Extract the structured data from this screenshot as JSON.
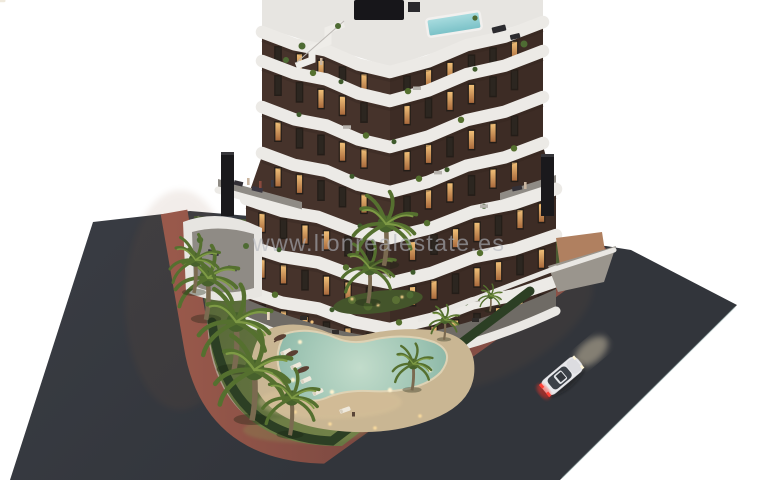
{
  "meta": {
    "type": "architectural-render",
    "description": "Aerial dusk 3D rendering of a modern apartment building with curved white balconies, rooftop plunge pool, landscaped garden with freeform swimming pool, palm trees and sun loungers, on a corner plot between two asphalt roads with a red-brown sidewalk; a white car drives on the right road."
  },
  "watermark": {
    "text": "www.lionrealestate.es"
  },
  "scene": {
    "elements": [
      "apartment-building",
      "rooftop-terrace",
      "rooftop-plunge-pool",
      "balcony-bands",
      "chimneys",
      "garden",
      "freeform-pool",
      "pool-deck",
      "sun-loungers",
      "parasols",
      "palm-trees",
      "hedge",
      "sidewalk-path",
      "asphalt-roads",
      "white-car",
      "watermark"
    ],
    "car": {
      "color": "white",
      "taillights_on": true,
      "headlights_on": true
    },
    "colors": {
      "background": "#ffffff",
      "asphalt": "#3b3e45",
      "asphalt_dark": "#33363c",
      "sidewalk_red": "#8e5349",
      "curb": "#b1a795",
      "grass": "#66763f",
      "grass_dark": "#4c5c33",
      "hedge": "#2c3f24",
      "pool_water": "#a7cbbb",
      "pool_water_deep": "#7fae9e",
      "pool_deck": "#c9b693",
      "facade": "#46332b",
      "facade_dark": "#362820",
      "balcony_white": "#eceae6",
      "roof_deck": "#e7e5e1",
      "terrace_floor": "#8f8b85",
      "chimney": "#1a191c",
      "rooftop_pool": "#8fd0d4",
      "window_glow": "#d99f5f",
      "window_dark": "#241d18",
      "palm_frond": "#55702f",
      "palm_frond_light": "#7e9a45",
      "palm_trunk": "#7a6a50",
      "car_body": "#e9e9ec",
      "car_glass": "#3c4148",
      "taillight": "#ff4238",
      "headlight_glow": "#ffeec8",
      "watermark": "#b2b6be"
    }
  }
}
